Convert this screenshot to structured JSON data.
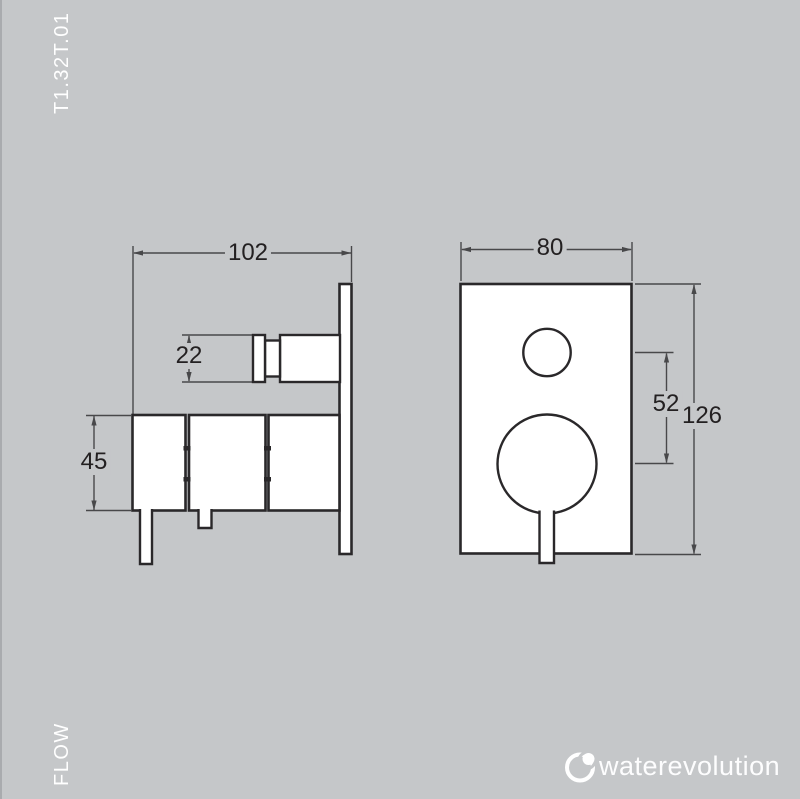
{
  "colors": {
    "background": "#c5c7c9",
    "edge_strip": "#a9abae",
    "outline": "#2a282a",
    "dimension_lines": "#48484a",
    "shape_fill": "#ffffff",
    "dimension_text": "#232021",
    "margin_text": "#ffffff",
    "logo": "#ffffff"
  },
  "margin_labels": {
    "product_code": "T1.32T.01",
    "flow_label": "FLOW"
  },
  "technical_drawing": {
    "side_view": {
      "dim_total_depth": "102",
      "dim_handle_length": "22",
      "dim_body_height": "45"
    },
    "front_view": {
      "dim_plate_width": "80",
      "dim_handle_distance": "52",
      "dim_plate_height": "126"
    }
  },
  "brand": {
    "wordmark": "waterevolution",
    "logo_icon": "water-drop-circle-icon"
  }
}
